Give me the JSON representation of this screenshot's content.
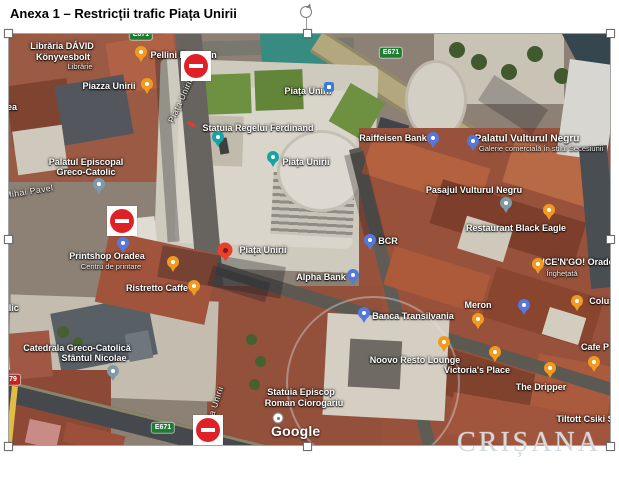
{
  "title": "Anexa 1 – Restricții trafic Piața Unirii",
  "watermark": "CRIȘANA",
  "map": {
    "google_logo": "Google",
    "labels": [
      {
        "t": "Librăria DÁVID",
        "x": 53,
        "y": 13
      },
      {
        "t": "Könyvesbolt",
        "x": 54,
        "y": 24
      },
      {
        "t": "Librărie",
        "x": 71,
        "y": 33,
        "k": "sub"
      },
      {
        "t": "Pellini E",
        "x": 159,
        "y": 22
      },
      {
        "t": "n",
        "x": 205,
        "y": 22
      },
      {
        "t": "Piazza Unirii",
        "x": 100,
        "y": 53
      },
      {
        "t": "Piața Unirii",
        "x": 299,
        "y": 58
      },
      {
        "t": "Statuia Regelui Ferdinand",
        "x": 249,
        "y": 95
      },
      {
        "t": "Piața Unirii",
        "x": 297,
        "y": 129
      },
      {
        "t": "Raiffeisen Bank",
        "x": 384,
        "y": 105
      },
      {
        "t": "Palatul Vulturul Negru",
        "x": 518,
        "y": 105,
        "k": "big"
      },
      {
        "t": "Galerie comercială în stilul Secesiunii",
        "x": 532,
        "y": 115,
        "k": "sub"
      },
      {
        "t": "Palatul Episcopal",
        "x": 77,
        "y": 129
      },
      {
        "t": "Greco-Catolic",
        "x": 77,
        "y": 139
      },
      {
        "t": "Pasajul Vulturul Negru",
        "x": 465,
        "y": 157
      },
      {
        "t": "Restaurant Black Eagle",
        "x": 507,
        "y": 195
      },
      {
        "t": "BCR",
        "x": 379,
        "y": 208
      },
      {
        "t": "Alpha Bank",
        "x": 312,
        "y": 244
      },
      {
        "t": "ICE'N'GO! Orade",
        "x": 569,
        "y": 229
      },
      {
        "t": "Înghețată",
        "x": 553,
        "y": 240,
        "k": "sub"
      },
      {
        "t": "Meron",
        "x": 469,
        "y": 272
      },
      {
        "t": "Colun",
        "x": 593,
        "y": 268
      },
      {
        "t": "Banca Transilvania",
        "x": 404,
        "y": 283
      },
      {
        "t": "Noovo Resto Lounge",
        "x": 406,
        "y": 327
      },
      {
        "t": "Victoria's Place",
        "x": 468,
        "y": 337
      },
      {
        "t": "The Dripper",
        "x": 532,
        "y": 354
      },
      {
        "t": "Cafe P",
        "x": 586,
        "y": 314
      },
      {
        "t": "Tiltott Csiki S",
        "x": 576,
        "y": 386
      },
      {
        "t": "Statuia Episcop",
        "x": 292,
        "y": 359
      },
      {
        "t": "Roman Ciorogariu",
        "x": 295,
        "y": 370
      },
      {
        "t": "Catedrala Greco-Catolică",
        "x": 68,
        "y": 315
      },
      {
        "t": "Sfântul Nicolae",
        "x": 85,
        "y": 325
      },
      {
        "t": "Printshop Oradea",
        "x": 98,
        "y": 223
      },
      {
        "t": "Centru de printare",
        "x": 102,
        "y": 233,
        "k": "sub"
      },
      {
        "t": "Ristretto Caffe",
        "x": 148,
        "y": 255
      },
      {
        "t": "Piața Unirii",
        "x": 254,
        "y": 217
      },
      {
        "t": "ea",
        "x": 3,
        "y": 74
      },
      {
        "t": "olic",
        "x": 2,
        "y": 275
      },
      {
        "t": "Piața Unirii",
        "x": 172,
        "y": 67,
        "r": -65,
        "k": "street"
      },
      {
        "t": "Piața Unirii",
        "x": 205,
        "y": 375,
        "r": -72,
        "k": "street"
      },
      {
        "t": "Mihai Pavel",
        "x": 20,
        "y": 158,
        "r": -9,
        "k": "street"
      }
    ],
    "badges": [
      {
        "t": "E671",
        "x": 382,
        "y": 19,
        "c": "green"
      },
      {
        "t": "E671",
        "x": 132,
        "y": 1,
        "c": "green"
      },
      {
        "t": "E671",
        "x": 154,
        "y": 394,
        "c": "green"
      },
      {
        "t": "79",
        "x": 4,
        "y": 346,
        "c": "red"
      }
    ],
    "pins": [
      {
        "k": "orange",
        "x": 132,
        "y": 18,
        "n": "coffee-pin"
      },
      {
        "k": "orange",
        "x": 138,
        "y": 50,
        "n": "restaurant-pin"
      },
      {
        "k": "blue",
        "x": 114,
        "y": 209,
        "n": "printshop-pin"
      },
      {
        "k": "orange",
        "x": 164,
        "y": 228,
        "n": "coffee-pin"
      },
      {
        "k": "orange",
        "x": 185,
        "y": 252,
        "n": "coffee-pin"
      },
      {
        "k": "gray",
        "x": 90,
        "y": 150,
        "n": "church-pin"
      },
      {
        "k": "gray",
        "x": 104,
        "y": 337,
        "n": "church-pin"
      },
      {
        "k": "teal",
        "x": 209,
        "y": 103,
        "n": "monument-pin"
      },
      {
        "k": "teal",
        "x": 264,
        "y": 123,
        "n": "square-poi-pin"
      },
      {
        "k": "busstop",
        "x": 320,
        "y": 53,
        "n": "bus-stop-icon"
      },
      {
        "k": "blue",
        "x": 424,
        "y": 104,
        "n": "bank-pin"
      },
      {
        "k": "blue",
        "x": 464,
        "y": 107,
        "n": "shopping-pin"
      },
      {
        "k": "gray",
        "x": 497,
        "y": 169,
        "n": "passage-pin"
      },
      {
        "k": "orange",
        "x": 540,
        "y": 176,
        "n": "restaurant-pin"
      },
      {
        "k": "orange",
        "x": 529,
        "y": 230,
        "n": "icecream-pin"
      },
      {
        "k": "blue",
        "x": 515,
        "y": 271,
        "n": "shopping-pin"
      },
      {
        "k": "orange",
        "x": 469,
        "y": 285,
        "n": "coffee-pin"
      },
      {
        "k": "orange",
        "x": 568,
        "y": 267,
        "n": "bar-pin"
      },
      {
        "k": "blue",
        "x": 355,
        "y": 279,
        "n": "bank-pin"
      },
      {
        "k": "blue",
        "x": 361,
        "y": 206,
        "n": "bank-pin"
      },
      {
        "k": "blue",
        "x": 344,
        "y": 241,
        "n": "bank-pin"
      },
      {
        "k": "orange",
        "x": 435,
        "y": 308,
        "n": "restaurant-pin"
      },
      {
        "k": "orange",
        "x": 486,
        "y": 318,
        "n": "restaurant-pin"
      },
      {
        "k": "orange",
        "x": 541,
        "y": 334,
        "n": "coffee-pin"
      },
      {
        "k": "orange",
        "x": 585,
        "y": 328,
        "n": "coffee-pin"
      },
      {
        "k": "whitedot",
        "x": 269,
        "y": 384,
        "n": "poi-dot"
      },
      {
        "k": "marker",
        "x": 216,
        "y": 216,
        "n": "destination-marker"
      }
    ],
    "no_entry_signs": [
      {
        "x": 172,
        "y": 17
      },
      {
        "x": 98,
        "y": 172
      },
      {
        "x": 184,
        "y": 381
      }
    ],
    "closed_road_dash": {
      "x": 178,
      "y": 89
    },
    "colors": {
      "no_entry_red": "#DE2127",
      "pin_orange": "#F09A1F",
      "pin_blue": "#5677DB",
      "pin_teal": "#16A3A3",
      "pin_gray": "#7E99A8",
      "marker_red": "#E8402F",
      "badge_green": "#1E7C33",
      "badge_red": "#C5221F",
      "watermark_gray": "#d4d9de"
    }
  }
}
